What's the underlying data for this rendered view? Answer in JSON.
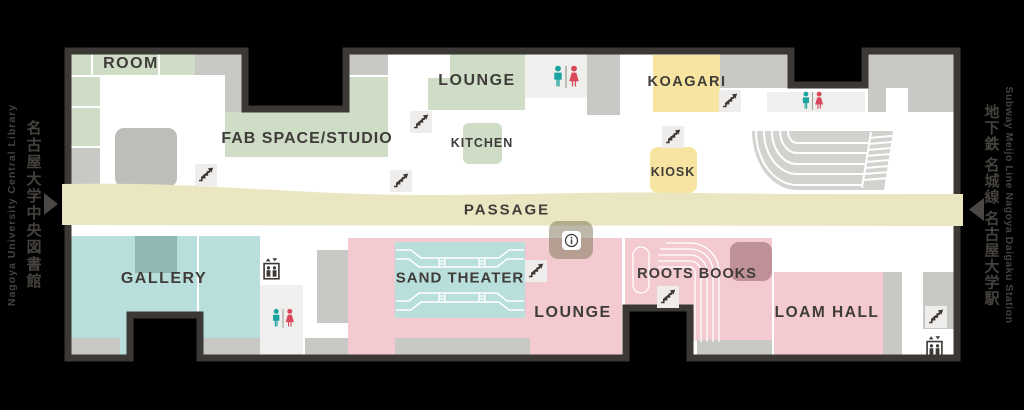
{
  "map_title": "floor-map",
  "palette": {
    "outline": "#3b3835",
    "floor": "#ffffff",
    "green": "#cfddc7",
    "gray": "#c8c8c5",
    "gray_block": "#bdbdb9",
    "gray_light": "#efefed",
    "yellow": "#f6e4a0",
    "cream": "#ebe6c2",
    "teal": "#b9dfdc",
    "teal_dark": "#8fb8b4",
    "pink": "#f2cad0",
    "mauve": "#bf9097",
    "amphitheater_gray": "#d2d2cf",
    "man": "#18a2a0",
    "woman": "#d8475a",
    "label_text": "#3f3c39",
    "white": "#ffffff"
  },
  "rooms": {
    "room": {
      "label": "ROOM"
    },
    "fab_space": {
      "label": "FAB SPACE/STUDIO"
    },
    "lounge_north": {
      "label": "LOUNGE"
    },
    "kitchen": {
      "label": "KITCHEN"
    },
    "koagari": {
      "label": "KOAGARI"
    },
    "kiosk": {
      "label": "KIOSK"
    },
    "passage": {
      "label": "PASSAGE"
    },
    "gallery": {
      "label": "GALLERY"
    },
    "sand_theater": {
      "label": "SAND THEATER"
    },
    "lounge_south": {
      "label": "LOUNGE"
    },
    "roots_books": {
      "label": "ROOTS BOOKS"
    },
    "loam_hall": {
      "label": "LOAM HALL"
    }
  },
  "wayfinding": {
    "left": {
      "en": "Nagoya University Central Library",
      "ja": "名古屋大学中央図書館"
    },
    "right": {
      "en": "Subway Meijo Line Nagoya Daigaku Station",
      "ja": "地下鉄 名城線 名古屋大学駅"
    }
  },
  "icons": {
    "stairs": "stairs-up",
    "restroom": "restroom-men-women",
    "elevator": "elevator",
    "info": "information",
    "entrance_left": "arrow-right",
    "entrance_right": "arrow-left"
  }
}
